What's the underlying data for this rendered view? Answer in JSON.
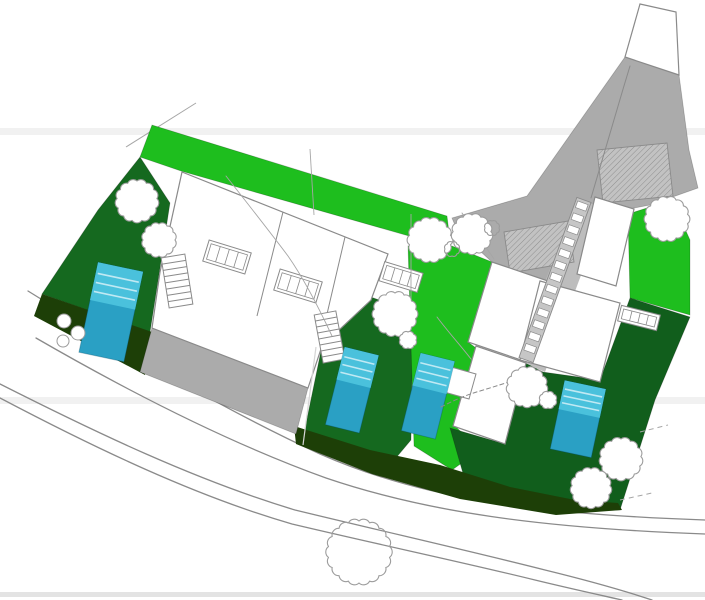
{
  "canvas": {
    "width": 705,
    "height": 600,
    "background": "#ffffff"
  },
  "palette": {
    "white": "#ffffff",
    "brightGreen": "#1ebe1e",
    "midGreen": "#15691f",
    "midGreen2": "#115e1c",
    "darkestGreen": "#1d3f07",
    "grayDrive": "#ababab",
    "grayCorridor": "#bdbdbd",
    "ladderBg": "#c6c6c6",
    "hatchBg": "#c2c2c2",
    "hatchLine": "#8f8f8f",
    "outline": "#8a8a8a",
    "treeStroke": "#9c9c9c",
    "poolTop": "#4ac1dc",
    "poolBottom": "#2aa0c4",
    "poolStripe": "rgba(255,255,255,0.65)",
    "poolEdge": "rgba(0,70,95,0.30)",
    "roadStroke": "#8a8a8a",
    "contour": "#a6a6a6",
    "bandFaint": "#f1f1f1",
    "bandBottom": "#e3e3e3",
    "edgeLine": "rgba(0,0,0,0.22)"
  },
  "shapes": [
    {
      "name": "artifact-band-upper",
      "type": "rect",
      "x": 0,
      "y": 128,
      "w": 705,
      "h": 7,
      "fill": "bandFaint"
    },
    {
      "name": "artifact-band-middle",
      "type": "rect",
      "x": 0,
      "y": 397,
      "w": 705,
      "h": 7,
      "fill": "bandFaint"
    },
    {
      "name": "artifact-band-bottom",
      "type": "rect",
      "x": 0,
      "y": 592,
      "w": 705,
      "h": 5,
      "fill": "bandBottom"
    },
    {
      "name": "road-upper-line-1",
      "type": "path",
      "d": "M28,291 C120,348 220,408 320,454 C420,498 530,514 705,520",
      "stroke": "roadStroke",
      "sw": 1.3
    },
    {
      "name": "road-upper-line-2",
      "type": "path",
      "d": "M36,338 C126,390 226,442 326,478 C426,512 540,528 705,534",
      "stroke": "roadStroke",
      "sw": 1.3
    },
    {
      "name": "road-lower-line-1",
      "type": "path",
      "d": "M0,384 C95,432 195,480 295,510 C390,533 470,551 545,570 C590,581 625,591 652,600",
      "stroke": "roadStroke",
      "sw": 1.3
    },
    {
      "name": "road-lower-line-2",
      "type": "path",
      "d": "M0,398 C95,448 195,496 292,524 C385,546 462,562 535,580 C572,589 600,595 622,600",
      "stroke": "roadStroke",
      "sw": 1.3
    },
    {
      "name": "survey-line-top-left",
      "type": "line",
      "x1": 196,
      "y1": 103,
      "x2": 126,
      "y2": 147,
      "stroke": "contour",
      "sw": 1
    },
    {
      "name": "lawn-top-band",
      "type": "polygon",
      "pts": [
        152,
        125,
        447,
        216,
        451,
        248,
        181,
        171,
        140,
        157
      ],
      "fill": "brightGreen",
      "stroke": "edgeLine",
      "sw": 0.8
    },
    {
      "name": "garden-west-strip",
      "type": "polygon",
      "pts": [
        140,
        157,
        170,
        203,
        160,
        268,
        150,
        332,
        42,
        294,
        98,
        210
      ],
      "fill": "midGreen",
      "stroke": "edgeLine",
      "sw": 0.8
    },
    {
      "name": "garden-lot2",
      "type": "polygon",
      "pts": [
        368,
        296,
        413,
        312,
        411,
        440,
        390,
        465,
        302,
        443,
        322,
        346
      ],
      "fill": "midGreen",
      "stroke": "edgeLine",
      "sw": 0.8
    },
    {
      "name": "lawn-middle-corridor",
      "type": "polygon",
      "pts": [
        408,
        246,
        452,
        246,
        492,
        262,
        468,
        342,
        476,
        348,
        455,
        426,
        480,
        450,
        452,
        470,
        414,
        446
      ],
      "fill": "brightGreen",
      "stroke": "edgeLine",
      "sw": 0.8
    },
    {
      "name": "lawn-right-patch",
      "type": "polygon",
      "pts": [
        628,
        214,
        672,
        200,
        690,
        240,
        690,
        315,
        630,
        298
      ],
      "fill": "brightGreen",
      "stroke": "edgeLine",
      "sw": 0.8
    },
    {
      "name": "garden-right-lot",
      "type": "polygon",
      "pts": [
        450,
        428,
        505,
        444,
        526,
        363,
        543,
        372,
        600,
        380,
        630,
        298,
        690,
        317,
        655,
        400,
        620,
        510,
        560,
        512,
        470,
        498
      ],
      "fill": "midGreen2",
      "stroke": "edgeLine",
      "sw": 0.8
    },
    {
      "name": "slope-band-left",
      "type": "polygon",
      "pts": [
        42,
        294,
        152,
        332,
        145,
        375,
        34,
        316
      ],
      "fill": "darkestGreen"
    },
    {
      "name": "slope-band-bottom",
      "type": "polygon",
      "pts": [
        294,
        426,
        370,
        450,
        440,
        465,
        510,
        487,
        575,
        500,
        618,
        503,
        622,
        510,
        556,
        515,
        460,
        499,
        372,
        474,
        296,
        444
      ],
      "fill": "darkestGreen"
    },
    {
      "name": "driveway-top-strip",
      "type": "polygon",
      "pts": [
        625,
        57,
        679,
        75,
        689,
        150,
        698,
        188,
        650,
        205,
        592,
        216,
        566,
        222,
        573,
        262,
        548,
        281,
        492,
        262,
        457,
        230,
        452,
        218,
        527,
        196
      ],
      "fill": "grayDrive",
      "stroke": "edgeLine",
      "sw": 0.8
    },
    {
      "name": "stair-corridor",
      "type": "polygon",
      "pts": [
        578,
        200,
        606,
        208,
        545,
        372,
        514,
        358
      ],
      "fill": "grayCorridor"
    },
    {
      "name": "driveway-left",
      "type": "polygon",
      "pts": [
        152,
        328,
        308,
        388,
        296,
        434,
        140,
        372
      ],
      "fill": "grayDrive",
      "stroke": "edgeLine",
      "sw": 0.8
    },
    {
      "name": "apex-plot",
      "type": "polygon",
      "pts": [
        640,
        4,
        676,
        12,
        679,
        75,
        625,
        57
      ],
      "fill": "white",
      "stroke": "outline",
      "sw": 1.2
    },
    {
      "name": "parking-hatch-upper",
      "type": "hatch",
      "pts": [
        597,
        150,
        667,
        143,
        673,
        196,
        603,
        203
      ]
    },
    {
      "name": "parking-hatch-lower",
      "type": "hatch",
      "pts": [
        504,
        232,
        568,
        221,
        574,
        262,
        510,
        273
      ]
    },
    {
      "name": "driveway-divider-line",
      "type": "path",
      "d": "M630,66 C616,112 602,160 591,198",
      "stroke": "outline",
      "sw": 1
    },
    {
      "name": "building-left-pair",
      "type": "polygon",
      "pts": [
        182,
        172,
        388,
        254,
        371,
        300,
        322,
        346,
        308,
        388,
        152,
        328,
        160,
        272
      ],
      "fill": "white",
      "stroke": "outline",
      "sw": 1.2
    },
    {
      "name": "building-left-divider-1",
      "type": "line",
      "x1": 283,
      "y1": 212,
      "x2": 257,
      "y2": 316,
      "stroke": "outline",
      "sw": 1
    },
    {
      "name": "building-left-divider-2",
      "type": "line",
      "x1": 345,
      "y1": 237,
      "x2": 320,
      "y2": 344,
      "stroke": "outline",
      "sw": 1
    },
    {
      "name": "building-middle-upper",
      "type": "polygon",
      "pts": [
        492,
        262,
        548,
        281,
        524,
        361,
        468,
        342
      ],
      "fill": "white",
      "stroke": "outline",
      "sw": 1.2
    },
    {
      "name": "building-middle-lower",
      "type": "polygon",
      "pts": [
        476,
        346,
        526,
        363,
        505,
        444,
        453,
        426
      ],
      "fill": "white",
      "stroke": "outline",
      "sw": 1.2
    },
    {
      "name": "terrace-middle",
      "type": "polygon",
      "pts": [
        444,
        365,
        476,
        374,
        469,
        399,
        437,
        390
      ],
      "fill": "white",
      "stroke": "outline",
      "sw": 1
    },
    {
      "name": "building-right-upper",
      "type": "polygon",
      "pts": [
        595,
        197,
        634,
        209,
        616,
        286,
        577,
        274
      ],
      "fill": "white",
      "stroke": "outline",
      "sw": 1.2
    },
    {
      "name": "building-right-lower",
      "type": "polygon",
      "pts": [
        540,
        281,
        620,
        303,
        600,
        382,
        520,
        360
      ],
      "fill": "white",
      "stroke": "outline",
      "sw": 1.2
    },
    {
      "name": "rooflight-left-1",
      "type": "panes",
      "cx": 227,
      "cy": 257,
      "w": 44,
      "h": 22,
      "a": 17
    },
    {
      "name": "rooflight-left-2",
      "type": "panes",
      "cx": 298,
      "cy": 286,
      "w": 44,
      "h": 22,
      "a": 17
    },
    {
      "name": "rooflight-left-3",
      "type": "panes",
      "cx": 401,
      "cy": 277,
      "w": 40,
      "h": 20,
      "a": 17
    },
    {
      "name": "rooflight-right",
      "type": "panes",
      "cx": 639,
      "cy": 318,
      "w": 40,
      "h": 16,
      "a": 14
    },
    {
      "name": "stairs-left-unit1",
      "type": "ladder",
      "x1": 173,
      "y1": 256,
      "x2": 181,
      "y2": 306,
      "w": 24,
      "n": 7,
      "style": "lines"
    },
    {
      "name": "stairs-left-unit2",
      "type": "ladder",
      "x1": 325,
      "y1": 313,
      "x2": 334,
      "y2": 361,
      "w": 22,
      "n": 7,
      "style": "lines"
    },
    {
      "name": "stairs-central-long",
      "type": "ladder",
      "x1": 584,
      "y1": 200,
      "x2": 526,
      "y2": 360,
      "w": 15,
      "n": 13,
      "style": "blocks"
    },
    {
      "name": "pool-left",
      "type": "pool",
      "cx": 111,
      "cy": 312,
      "w": 46,
      "h": 92,
      "a": 12
    },
    {
      "name": "pool-lot2",
      "type": "pool",
      "cx": 352,
      "cy": 390,
      "w": 35,
      "h": 80,
      "a": 14
    },
    {
      "name": "pool-middle",
      "type": "pool",
      "cx": 428,
      "cy": 396,
      "w": 35,
      "h": 80,
      "a": 14
    },
    {
      "name": "pool-right",
      "type": "pool",
      "cx": 578,
      "cy": 419,
      "w": 42,
      "h": 70,
      "a": 12
    },
    {
      "name": "lot-line-1",
      "type": "line",
      "x1": 310,
      "y1": 149,
      "x2": 314,
      "y2": 215,
      "stroke": "contour",
      "sw": 0.9
    },
    {
      "name": "lot-line-2",
      "type": "line",
      "x1": 411,
      "y1": 214,
      "x2": 411,
      "y2": 300,
      "stroke": "contour",
      "sw": 0.9
    },
    {
      "name": "lot-line-3",
      "type": "line",
      "x1": 316,
      "y1": 347,
      "x2": 303,
      "y2": 445,
      "stroke": "#d5d5d5",
      "sw": 1.2
    },
    {
      "name": "contour-line-1",
      "type": "path",
      "d": "M226,176 C248,204 270,232 288,256 C302,276 318,306 332,336",
      "stroke": "contour",
      "sw": 0.9
    },
    {
      "name": "contour-line-2",
      "type": "path",
      "d": "M462,213 C472,228 484,244 494,259",
      "stroke": "contour",
      "sw": 0.9
    },
    {
      "name": "contour-line-3",
      "type": "path",
      "d": "M437,317 C449,333 461,346 471,359",
      "stroke": "contour",
      "sw": 0.9
    },
    {
      "name": "hedge-scribble",
      "type": "path",
      "d": "M441,407 Q462,396 480,391 Q500,385 518,379",
      "stroke": "outline",
      "sw": 1,
      "dash": "4,3"
    },
    {
      "name": "dash-mark-right-1",
      "type": "line",
      "x1": 640,
      "y1": 432,
      "x2": 668,
      "y2": 425,
      "stroke": "contour",
      "sw": 1,
      "dash": "5,4"
    },
    {
      "name": "dash-mark-right-2",
      "type": "line",
      "x1": 620,
      "y1": 500,
      "x2": 652,
      "y2": 493,
      "stroke": "contour",
      "sw": 1,
      "dash": "5,4"
    },
    {
      "name": "tree-west-1",
      "type": "tree",
      "cx": 137,
      "cy": 201,
      "r": 20,
      "fill": "white"
    },
    {
      "name": "tree-west-2",
      "type": "tree",
      "cx": 159,
      "cy": 240,
      "r": 16,
      "fill": "white"
    },
    {
      "name": "tree-center-1",
      "type": "tree",
      "cx": 430,
      "cy": 240,
      "r": 21,
      "fill": "white"
    },
    {
      "name": "tree-center-2",
      "type": "tree",
      "cx": 472,
      "cy": 234,
      "r": 19,
      "fill": "white"
    },
    {
      "name": "tree-center-2-lobe-1",
      "type": "tree",
      "cx": 452,
      "cy": 249,
      "r": 7,
      "fill": "none"
    },
    {
      "name": "tree-center-2-lobe-2",
      "type": "tree",
      "cx": 492,
      "cy": 228,
      "r": 7,
      "fill": "none"
    },
    {
      "name": "tree-mid-garden",
      "type": "tree",
      "cx": 395,
      "cy": 314,
      "r": 21,
      "fill": "white"
    },
    {
      "name": "tree-mid-garden-lobe",
      "type": "tree",
      "cx": 408,
      "cy": 340,
      "r": 8,
      "fill": "white"
    },
    {
      "name": "tree-right-top",
      "type": "tree",
      "cx": 667,
      "cy": 219,
      "r": 21,
      "fill": "white"
    },
    {
      "name": "tree-central",
      "type": "tree",
      "cx": 527,
      "cy": 387,
      "r": 19,
      "fill": "white"
    },
    {
      "name": "tree-central-lobe",
      "type": "tree",
      "cx": 548,
      "cy": 400,
      "r": 8,
      "fill": "white"
    },
    {
      "name": "tree-bottom-right-1",
      "type": "tree",
      "cx": 621,
      "cy": 459,
      "r": 20,
      "fill": "white"
    },
    {
      "name": "tree-bottom-right-2",
      "type": "tree",
      "cx": 591,
      "cy": 488,
      "r": 19,
      "fill": "white"
    },
    {
      "name": "tree-road",
      "type": "tree",
      "cx": 359,
      "cy": 552,
      "r": 31,
      "fill": "none"
    },
    {
      "name": "bush-1",
      "type": "circle",
      "cx": 64,
      "cy": 321,
      "r": 7
    },
    {
      "name": "bush-2",
      "type": "circle",
      "cx": 78,
      "cy": 333,
      "r": 7
    },
    {
      "name": "bush-3",
      "type": "circle",
      "cx": 63,
      "cy": 341,
      "r": 6
    }
  ]
}
